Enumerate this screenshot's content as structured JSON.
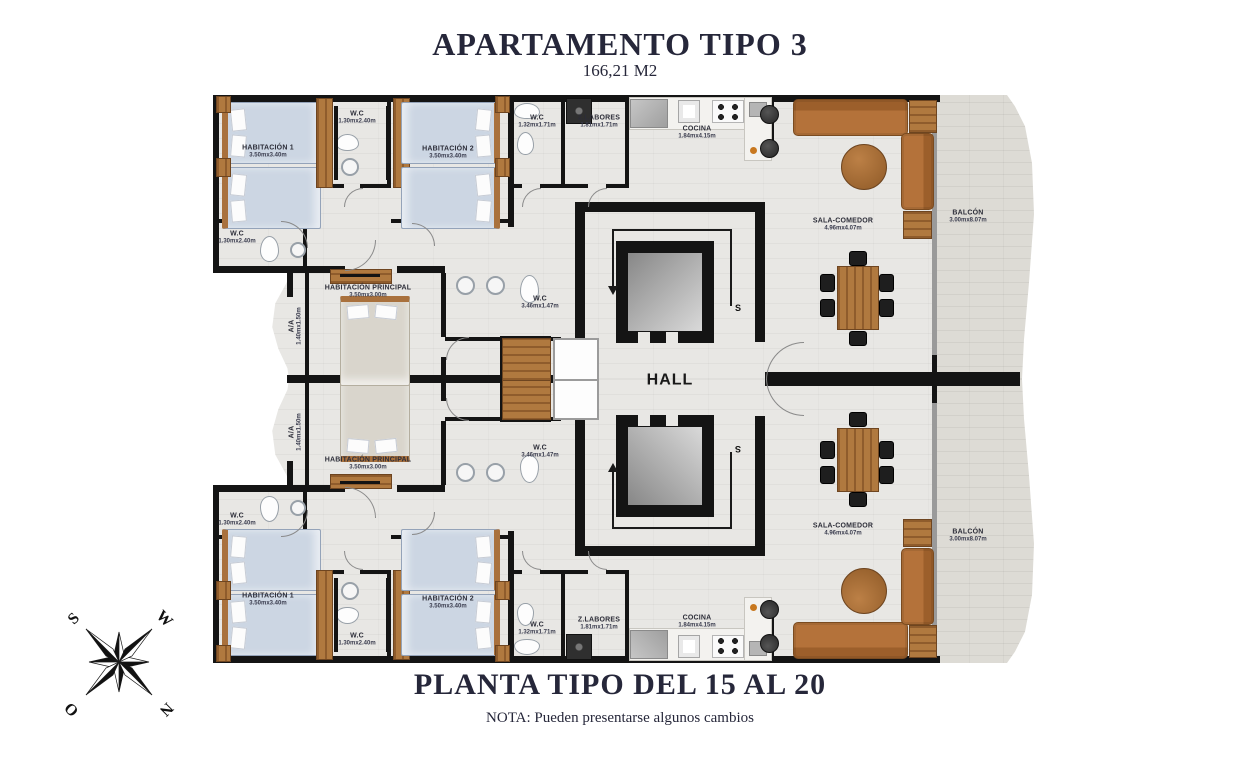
{
  "title": {
    "main": "APARTAMENTO TIPO 3",
    "area": "166,21 M2"
  },
  "footer": {
    "caption": "PLANTA TIPO DEL 15 AL 20",
    "note": "NOTA: Pueden presentarse algunos cambios"
  },
  "compass": {
    "s": "S",
    "w": "W",
    "o": "O",
    "n": "N"
  },
  "stairs": {
    "label": "S"
  },
  "rooms": {
    "hab1": {
      "name": "HABITACIÓN 1",
      "dims": "3.50mx3.40m"
    },
    "hab2": {
      "name": "HABITACIÓN 2",
      "dims": "3.50mx3.40m"
    },
    "wc_hab1": {
      "name": "W.C",
      "dims": "1.30mx2.40m"
    },
    "wc_center": {
      "name": "W.C",
      "dims": "1.30mx2.40m"
    },
    "wc_service": {
      "name": "W.C",
      "dims": "1.32mx1.71m"
    },
    "zlabores": {
      "name": "Z.LABORES",
      "dims": "1.81mx1.71m"
    },
    "cocina": {
      "name": "COCINA",
      "dims": "1.84mx4.15m"
    },
    "sala": {
      "name": "SALA-COMEDOR",
      "dims": "4.96mx4.07m"
    },
    "balcon": {
      "name": "BALCÓN",
      "dims": "3.00mx8.07m"
    },
    "hab_principal": {
      "name": "HABITACIÓN PRINCIPAL",
      "dims": "3.50mx3.00m"
    },
    "wc_principal": {
      "name": "W.C",
      "dims": "3.46mx1.47m"
    },
    "aa": {
      "name": "A/A",
      "dims": "1.40mx1.50m"
    },
    "hall": {
      "name": "HALL"
    }
  }
}
